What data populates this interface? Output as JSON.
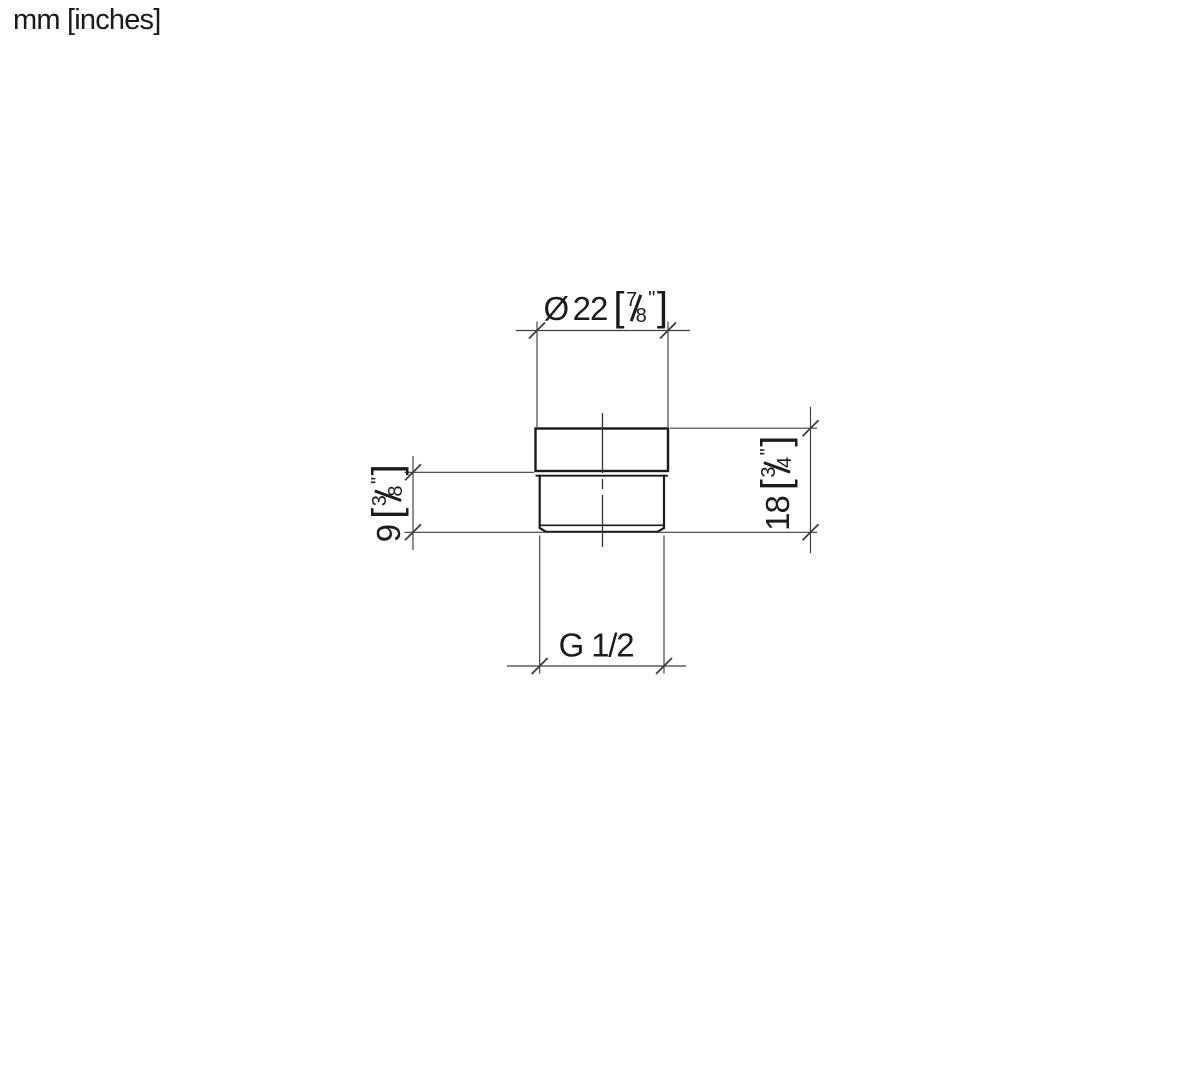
{
  "units_label": "mm [inches]",
  "dimensions": {
    "diameter": {
      "symbol": "Ø",
      "mm": "22",
      "bracket_open": "[",
      "frac_numerator": "7",
      "frac_denominator": "8",
      "inch_mark": "\"",
      "bracket_close": "]"
    },
    "lower_height": {
      "mm": "9",
      "bracket_open": "[",
      "frac_numerator": "3",
      "frac_denominator": "8",
      "inch_mark": "\"",
      "bracket_close": "]"
    },
    "total_height": {
      "mm": "18",
      "bracket_open": "[",
      "frac_numerator": "3",
      "frac_denominator": "4",
      "inch_mark": "\"",
      "bracket_close": "]"
    },
    "thread": {
      "label": "G 1/2"
    }
  },
  "style": {
    "outline_color": "#1a1a1a",
    "thin_line_color": "#3d3d3d",
    "text_color": "#1c1c1c",
    "background": "#ffffff"
  }
}
